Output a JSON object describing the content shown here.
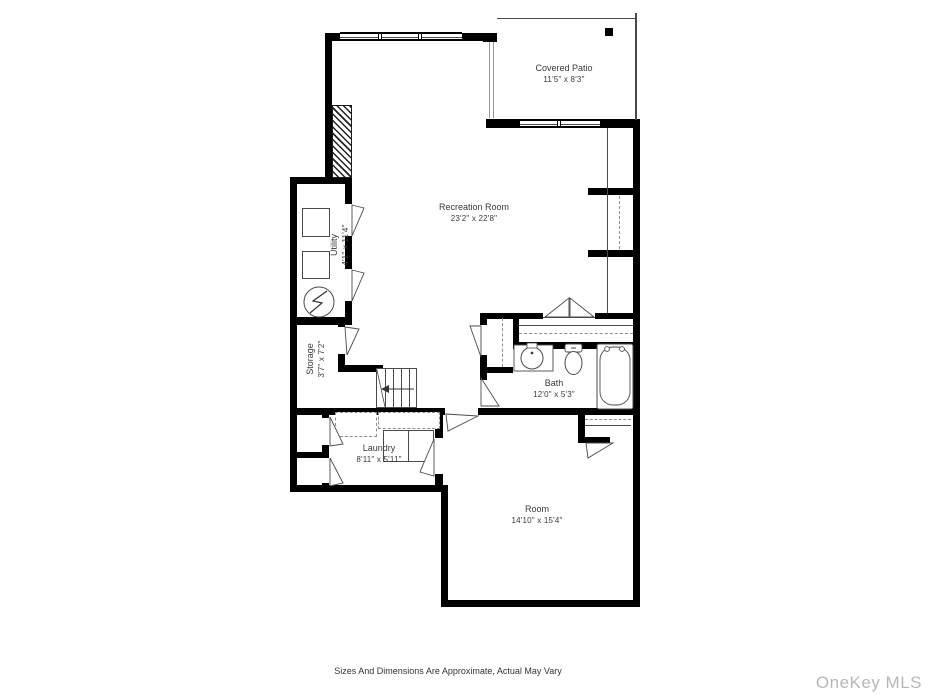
{
  "plan": {
    "footer": "Sizes And Dimensions Are Approximate, Actual May Vary",
    "watermark": "OneKey MLS",
    "rooms": [
      {
        "id": "recreation-room",
        "name": "Recreation Room",
        "dimensions": "23'2\" x 22'8\""
      },
      {
        "id": "covered-patio",
        "name": "Covered Patio",
        "dimensions": "11'5\" x 8'3\""
      },
      {
        "id": "utility",
        "name": "Utility",
        "dimensions": "4'1\" x 11'4\""
      },
      {
        "id": "storage",
        "name": "Storage",
        "dimensions": "3'7\" x 7'2\""
      },
      {
        "id": "laundry",
        "name": "Laundry",
        "dimensions": "8'11\" x 5'11\""
      },
      {
        "id": "bath",
        "name": "Bath",
        "dimensions": "12'0\" x 5'3\""
      },
      {
        "id": "room",
        "name": "Room",
        "dimensions": "14'10\" x 15'4\""
      }
    ],
    "colors": {
      "wall": "#000000",
      "fixture_line": "#4a4a4a",
      "dashed_line": "#8f8f8f",
      "label_text": "#3a3a3a",
      "watermark_text": "#b5b8ba",
      "background": "#ffffff"
    },
    "icons": {
      "stairs_direction": "arrow-left-icon",
      "utility_equipment": [
        "appliance-box-icon",
        "appliance-box-icon",
        "water-heater-icon"
      ],
      "bath_fixtures": [
        "sink-icon",
        "toilet-icon",
        "bathtub-icon"
      ],
      "structure": [
        "chimney-hatch",
        "window",
        "door-swing",
        "patio-post"
      ]
    }
  }
}
